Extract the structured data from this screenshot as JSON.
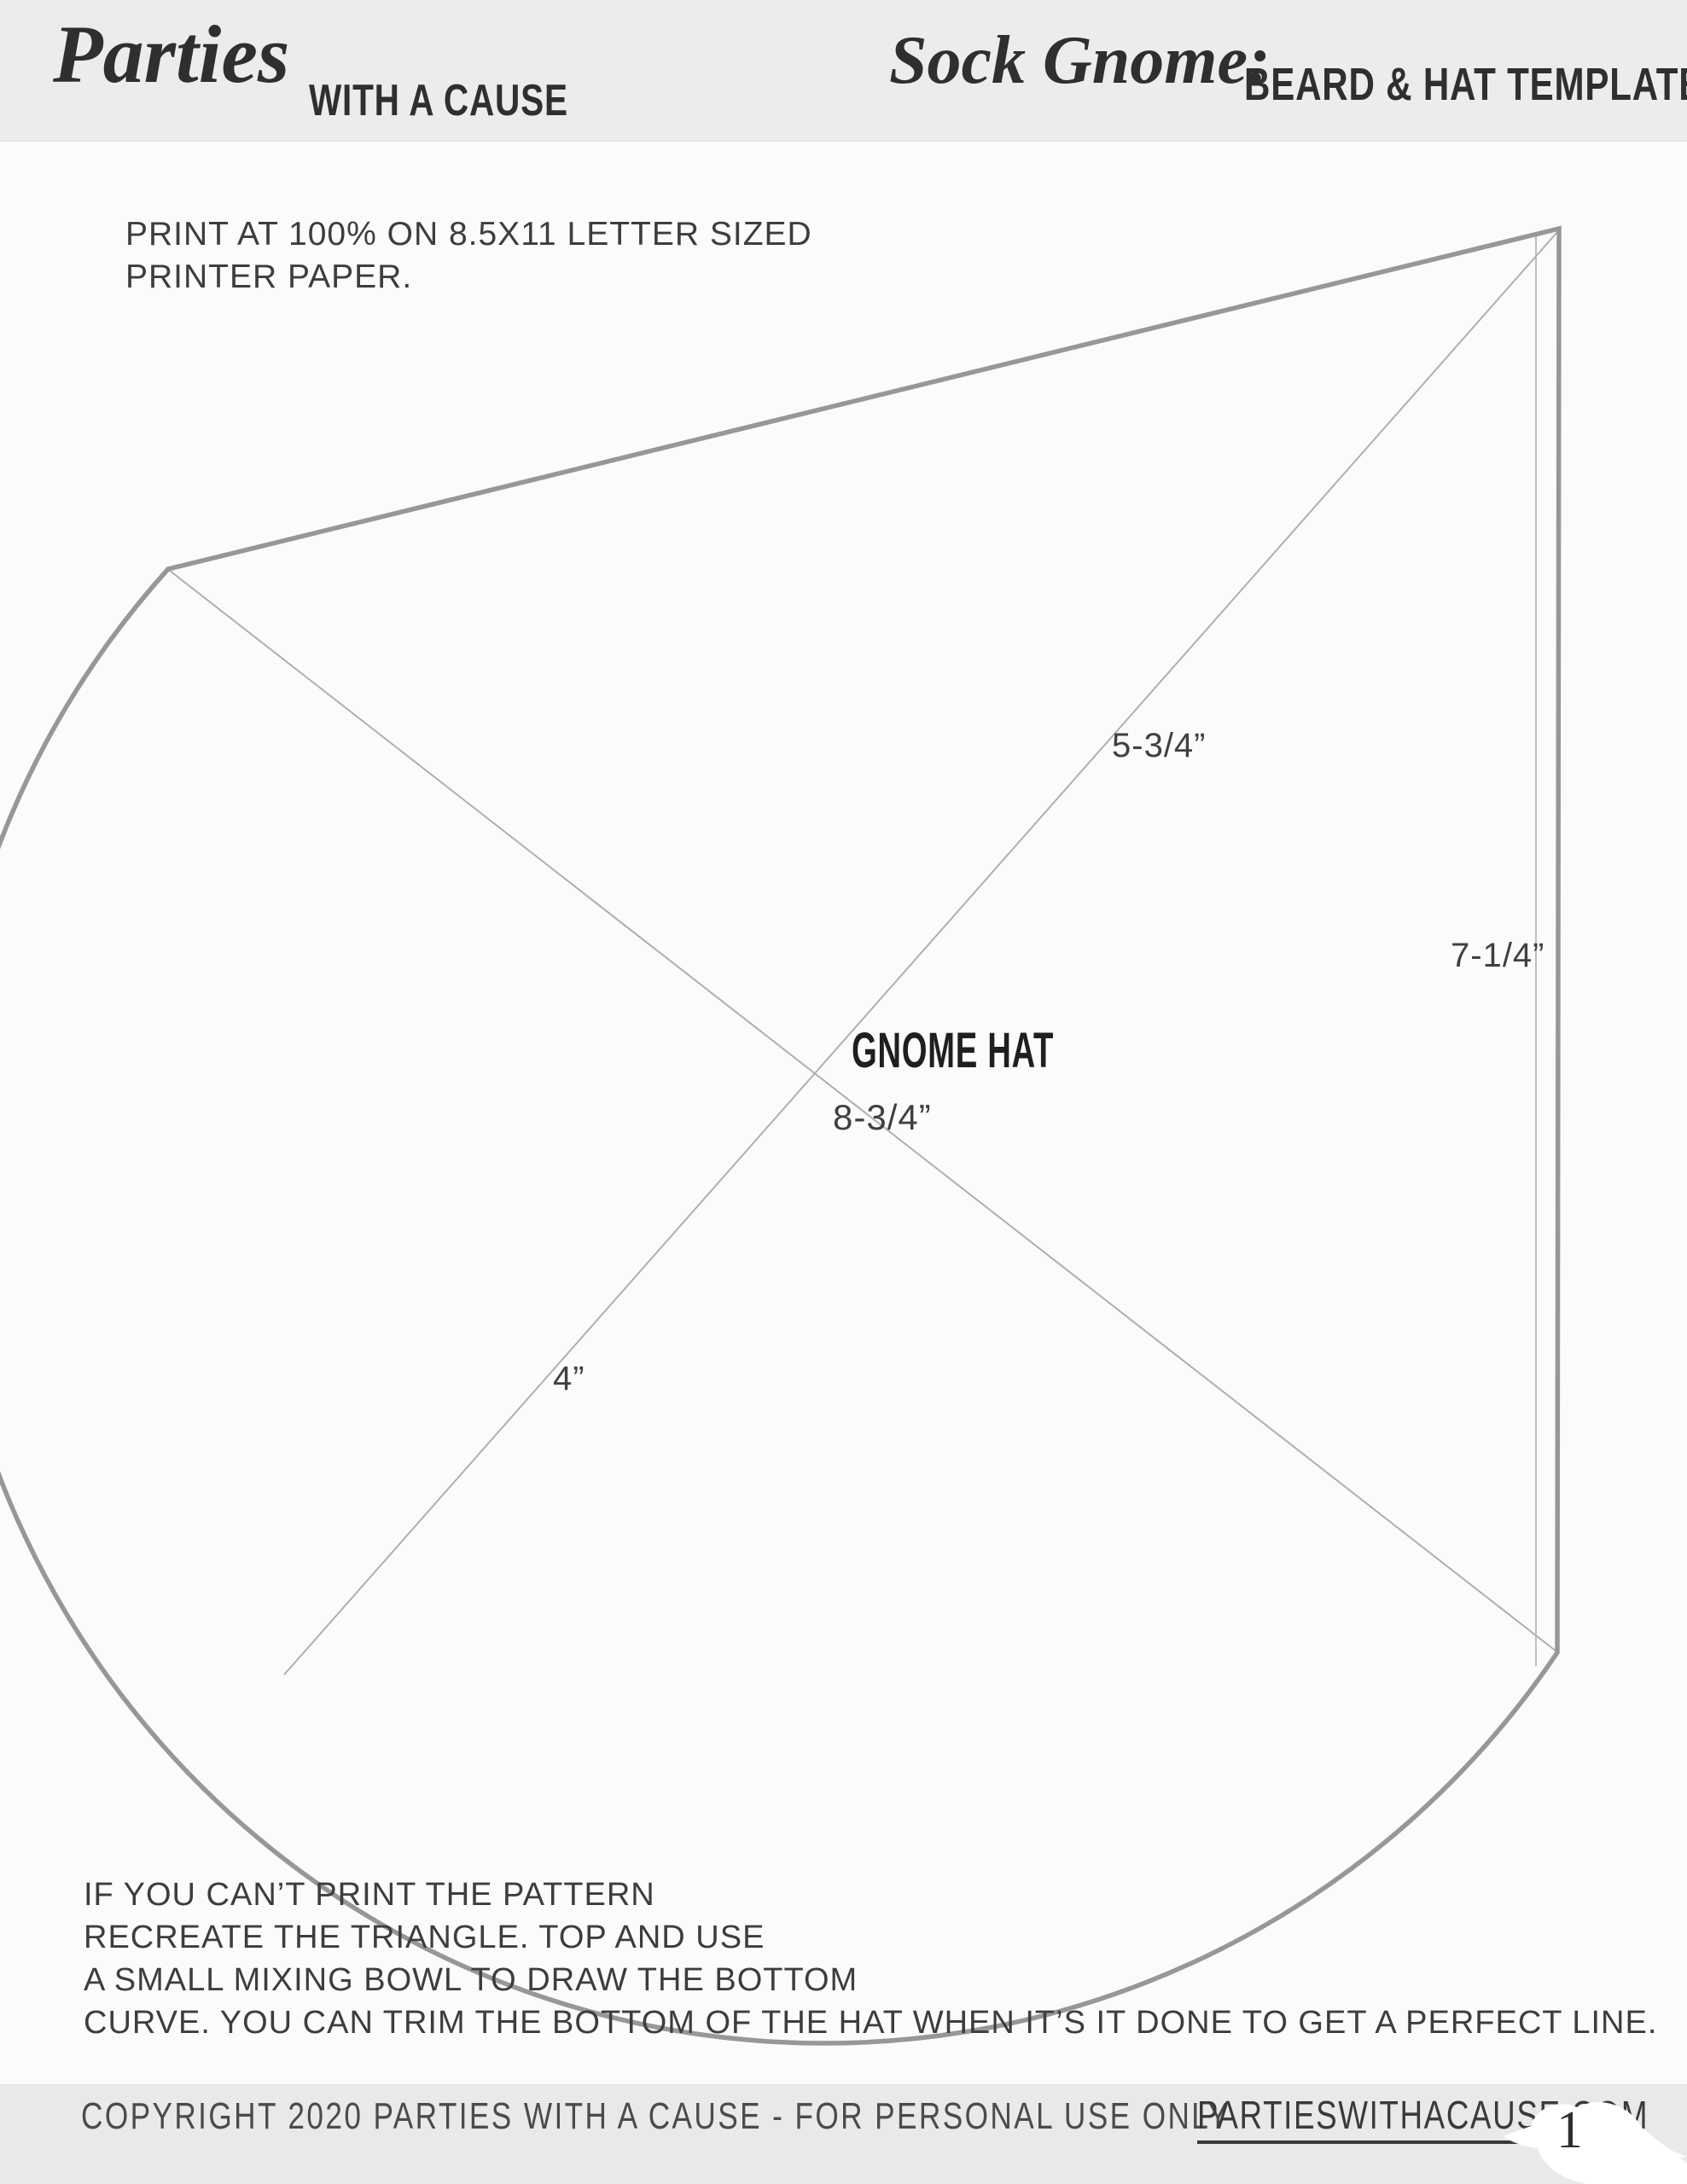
{
  "header": {
    "logo_script": "Parties",
    "logo_rest": "WITH A CAUSE",
    "title_script": "Sock Gnome:",
    "title_rest": "BEARD & HAT TEMPLATE"
  },
  "instructions_top": {
    "line1": "PRINT AT 100% ON 8.5X11 LETTER SIZED",
    "line2": "PRINTER PAPER."
  },
  "pattern": {
    "name": "GNOME HAT",
    "measurements": {
      "top_diagonal": "5-3/4”",
      "right_edge": "7-1/4”",
      "center_diagonal": "8-3/4”",
      "bottom_diagonal": "4”"
    }
  },
  "instructions_bottom": {
    "line1": "IF YOU CAN’T PRINT THE PATTERN",
    "line2": "RECREATE THE TRIANGLE. TOP AND USE",
    "line3": "A SMALL MIXING BOWL TO DRAW THE BOTTOM",
    "line4": "CURVE. YOU CAN TRIM THE BOTTOM OF THE HAT WHEN IT’S IT DONE TO GET A PERFECT LINE."
  },
  "footer": {
    "copyright": "COPYRIGHT 2020 PARTIES WITH A CAUSE - FOR PERSONAL USE ONLY",
    "website": "PARTIESWITHACAUSE.COM",
    "page_number": "1"
  },
  "colors": {
    "band": "#ececec",
    "band-footer": "#e9e9e9",
    "ink": "#2f2f2f",
    "body-text": "#3d3d3d",
    "label": "#404040",
    "outline": "#979797",
    "thin-line": "#b6c3c3",
    "diag-line": "#aab1b1",
    "paper": "#fbfbfa"
  }
}
